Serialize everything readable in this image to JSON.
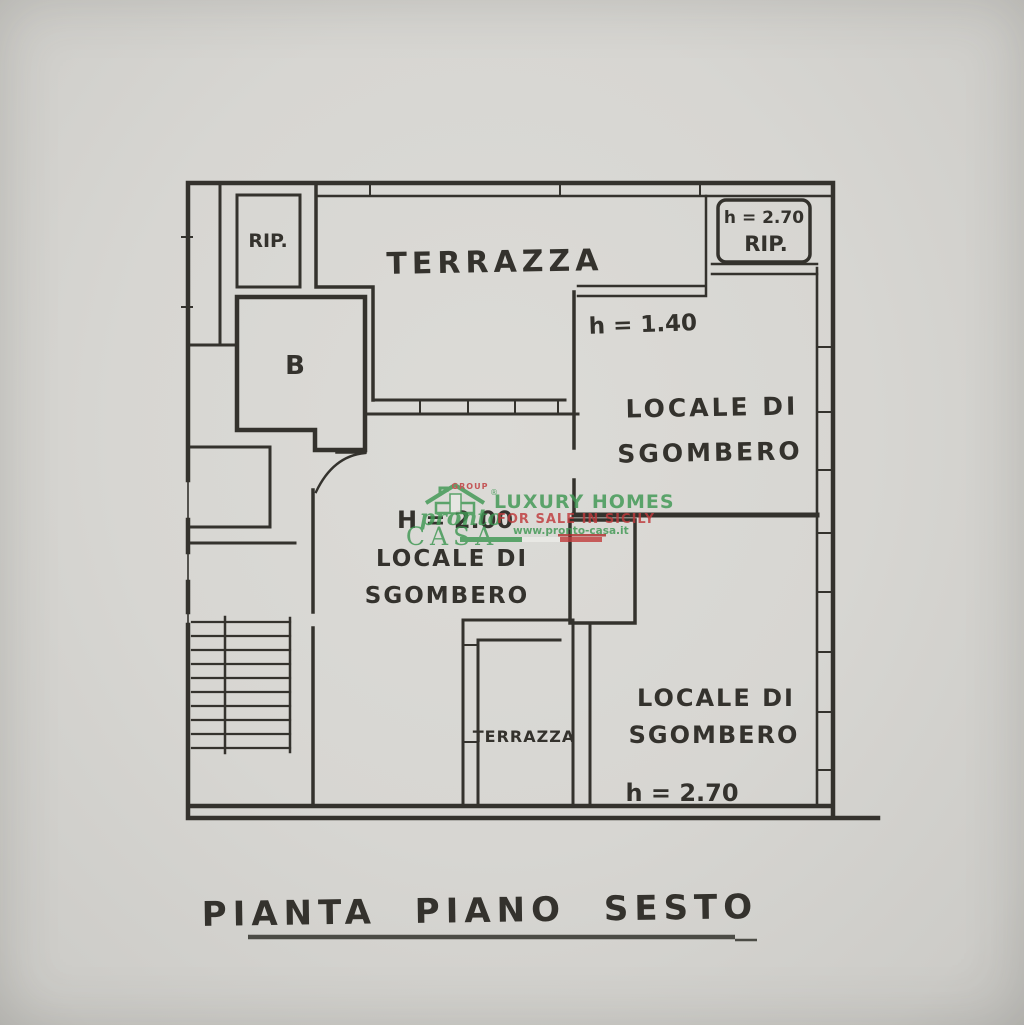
{
  "floor_plan": {
    "title": "PIANTA  PIANO  SESTO",
    "labels": {
      "terrace_top": "TERRAZZA",
      "rip_top_left": "RIP.",
      "room_b": "B",
      "rip_top_right_height": "h = 2.70",
      "rip_top_right": "RIP.",
      "height_140": "h = 1.40",
      "storage_upper_line1": "LOCALE DI",
      "storage_upper_line2": "SGOMBERO",
      "height_200": "H = 2.00",
      "storage_center_line1": "LOCALE DI",
      "storage_center_line2": "SGOMBERO",
      "terrace_bottom": "TERRAZZA",
      "storage_lower_line1": "LOCALE DI",
      "storage_lower_line2": "SGOMBERO",
      "height_270_bottom": "h = 2.70"
    }
  },
  "watermark": {
    "group": "GROUP",
    "registered": "®",
    "brand_line1": "pronto",
    "brand_line2": "CASA",
    "tagline_line1": "LUXURY HOMES",
    "tagline_line2": "FOR SALE IN SICILY",
    "website": "www.pronto-casa.it",
    "colors": {
      "green": "#3f9853",
      "red": "#bf3a3c"
    }
  }
}
